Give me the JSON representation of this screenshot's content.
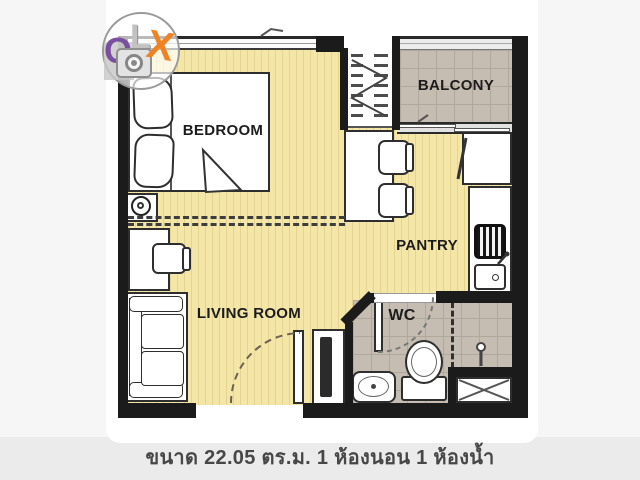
{
  "watermark": {
    "brand": "OLX",
    "letter_o": "O",
    "letter_l": "L",
    "letter_x": "X",
    "colors": {
      "o": "#7b4fa0",
      "l": "#c2c2c2",
      "x": "#ef8222",
      "leaf": "#7ab829"
    }
  },
  "floorplan": {
    "labels": {
      "bedroom": "BEDROOM",
      "balcony": "BALCONY",
      "pantry": "PANTRY",
      "living_room": "LIVING ROOM",
      "wc": "WC"
    },
    "colors": {
      "wood_floor": "#f3e6a7",
      "tile_floor": "#c6bdb2",
      "wall": "#1b1b1b",
      "furniture_outline": "#2e2e2e"
    },
    "fixtures": [
      "double-bed",
      "pillows",
      "bedside-table",
      "wardrobe",
      "window",
      "balcony-railing",
      "sliding-door",
      "room-partition",
      "dining-table",
      "dining-chairs",
      "refrigerator",
      "stove",
      "kitchen-sink",
      "kitchen-counter",
      "desk",
      "desk-chair",
      "sofa",
      "tv-cabinet",
      "entrance-door",
      "wc-door",
      "toilet",
      "wash-basin",
      "shower",
      "floor-drain"
    ]
  },
  "caption": {
    "text": "ขนาด 22.05 ตร.ม. 1 ห้องนอน 1 ห้องน้ำ",
    "area_sqm": "22.05",
    "bedrooms": "1",
    "bathrooms": "1"
  }
}
